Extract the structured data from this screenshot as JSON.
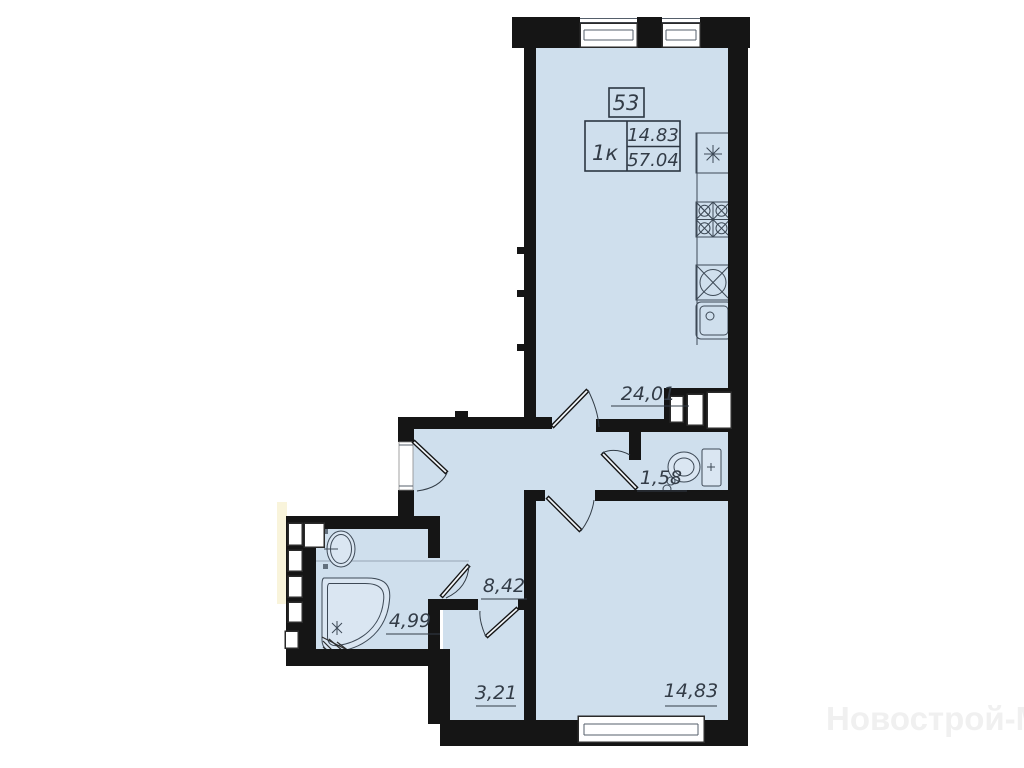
{
  "plan": {
    "apartment_number": "53",
    "legend": {
      "rooms_label": "1к",
      "living_area": "14.83",
      "total_area": "57.04"
    },
    "rooms": [
      {
        "name": "kitchen-living-room",
        "area_label": "24,01"
      },
      {
        "name": "toilet",
        "area_label": "1,58"
      },
      {
        "name": "hallway",
        "area_label": "8,42"
      },
      {
        "name": "bathroom",
        "area_label": "4,99"
      },
      {
        "name": "corridor",
        "area_label": "3,21"
      },
      {
        "name": "living-room",
        "area_label": "14,83"
      }
    ],
    "fixtures": [
      "vent-star-icon",
      "cooktop-icon",
      "hob-circle-icon",
      "kitchen-sink-icon",
      "toilet-icon",
      "washbasin-icon",
      "bathtub-icon"
    ],
    "watermark": "Новострой-М",
    "colors": {
      "room_fill": "#cfdfed",
      "wall": "#151515",
      "label_text": "#333c47",
      "fixture_stroke": "#3d4956",
      "outside_strip": "#f9f4db",
      "watermark": "#f0f0f0"
    }
  }
}
